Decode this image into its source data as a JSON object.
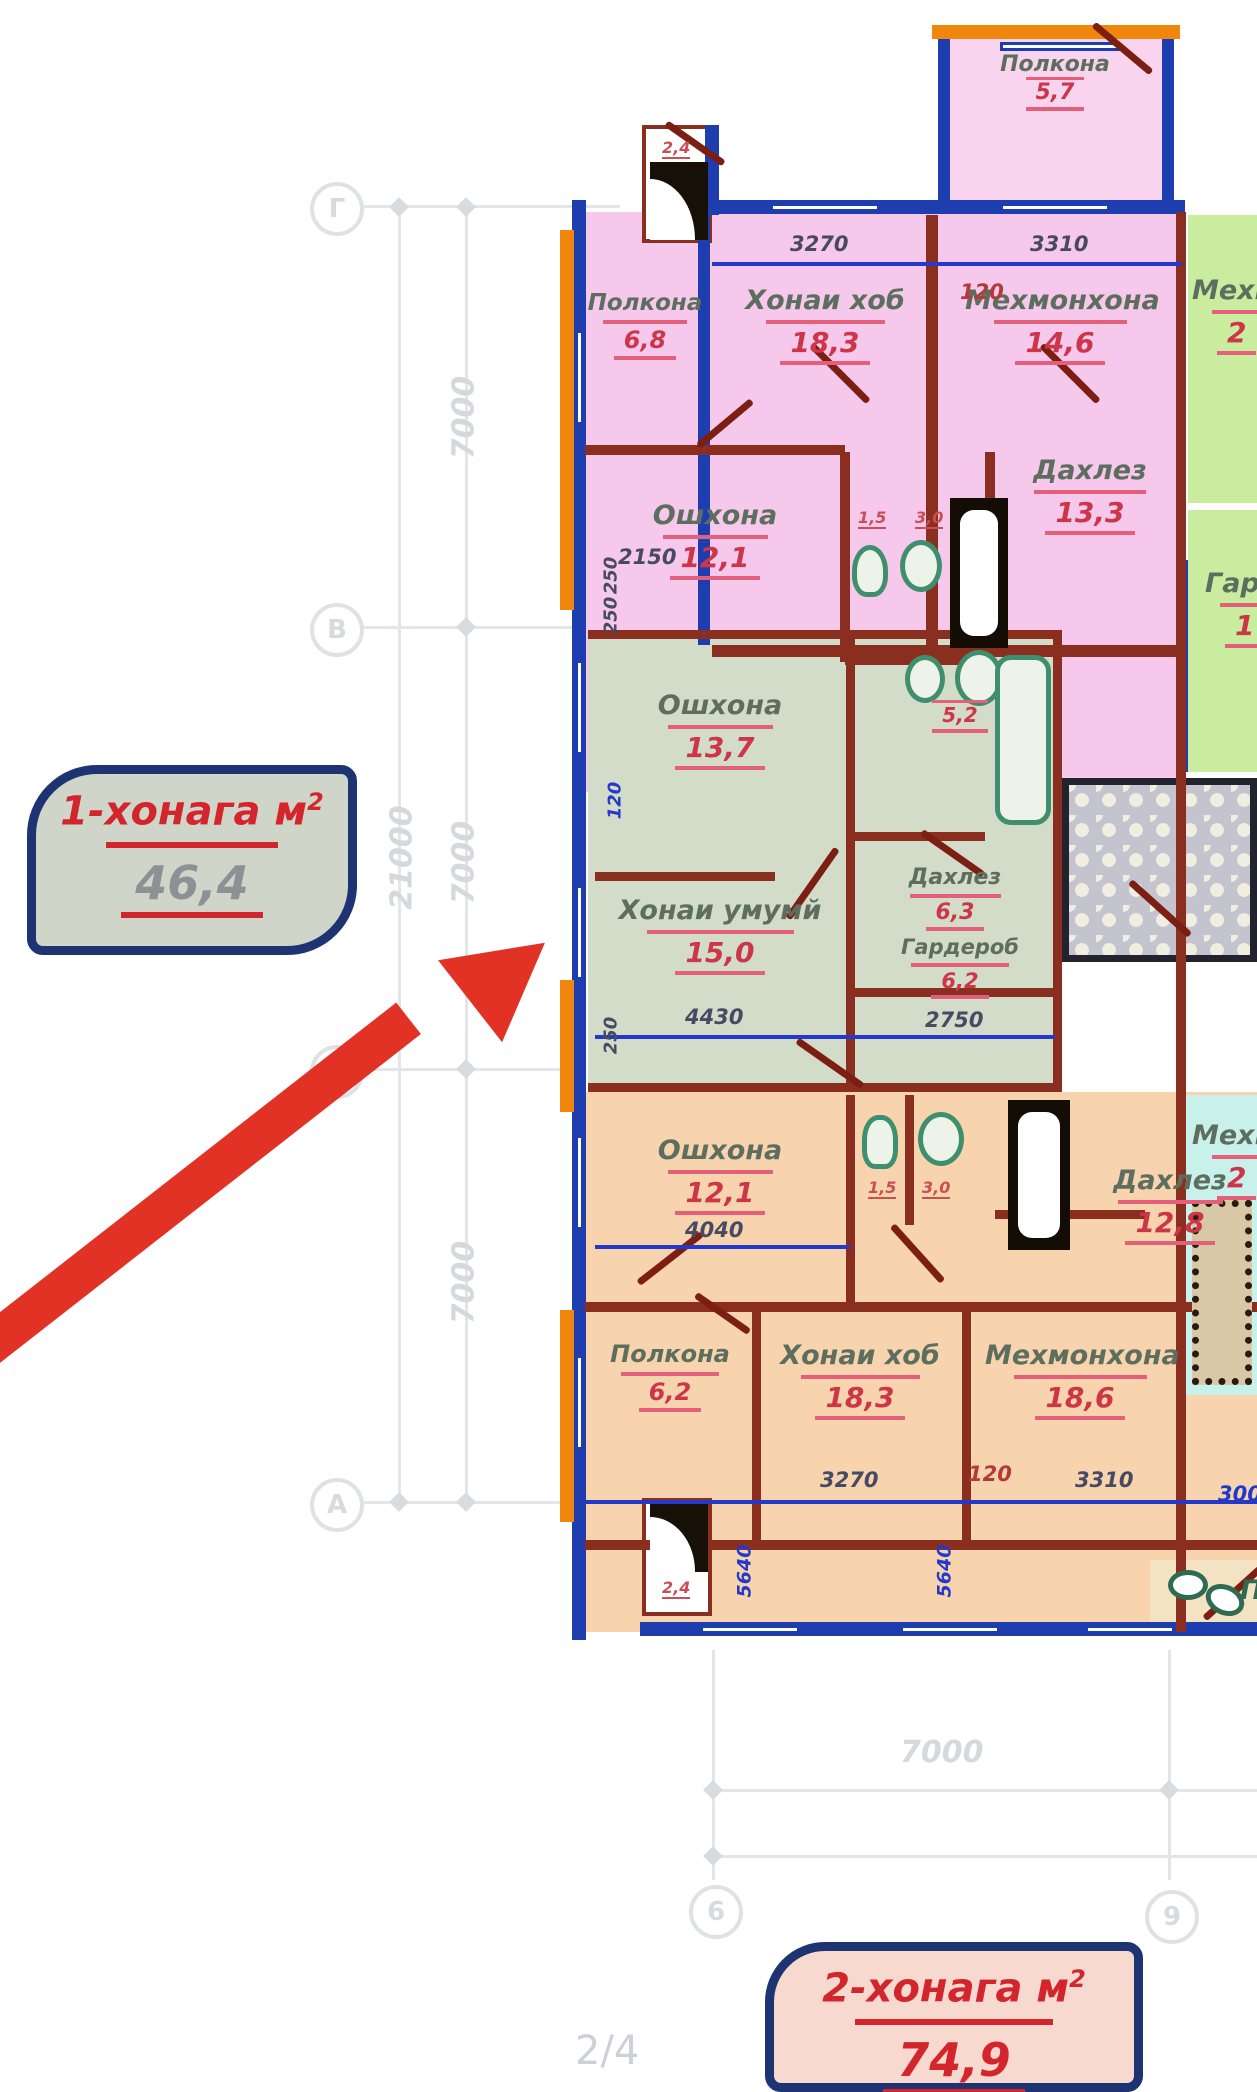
{
  "page": {
    "indicator": "2/4"
  },
  "callouts": {
    "one": {
      "title": "1-хонага м",
      "sup": "2",
      "value": "46,4"
    },
    "two": {
      "title": "2-хонага м",
      "sup": "2",
      "value": "74,9"
    }
  },
  "grid": {
    "rowLabels": [
      "Г",
      "В",
      "Б",
      "А"
    ],
    "colLabels": [
      "6",
      "9"
    ],
    "vTotal": "21000",
    "vSeg1": "7000",
    "vSeg2": "7000",
    "vSeg3": "7000",
    "hBottom": "7000"
  },
  "rooms": {
    "balconyTop": {
      "name": "Полкона",
      "area": "5,7"
    },
    "balcony24a": {
      "area": "2,4"
    },
    "balcony24b": {
      "area": "2,4"
    },
    "polkona68": {
      "name": "Полкона",
      "area": "6,8"
    },
    "khonaiKhob1": {
      "name": "Хонаи хоб",
      "area": "18,3"
    },
    "mehmonkhona1": {
      "name": "Мехмонхона",
      "area": "14,6"
    },
    "oshxona1": {
      "name": "Ошхона",
      "area": "12,1"
    },
    "dahlez1": {
      "name": "Дахлез",
      "area": "13,3"
    },
    "bath15a": {
      "area": "1,5"
    },
    "bath30a": {
      "area": "3,0"
    },
    "greenMehmon": {
      "name": "Мехм",
      "area": "2"
    },
    "greenGarderob": {
      "name": "Гар",
      "area": "1"
    },
    "oshxona2": {
      "name": "Ошхона",
      "area": "13,7"
    },
    "su52": {
      "area": "5,2"
    },
    "dahlez2": {
      "name": "Дахлез",
      "area": "6,3"
    },
    "khonaiUmumi": {
      "name": "Хонаи умумй",
      "area": "15,0"
    },
    "garderob2": {
      "name": "Гардероб",
      "area": "6,2"
    },
    "oshxona3": {
      "name": "Ошхона",
      "area": "12,1"
    },
    "bath15b": {
      "area": "1,5"
    },
    "bath30b": {
      "area": "3,0"
    },
    "dahlez3": {
      "name": "Дахлез",
      "area": "12,8"
    },
    "polkona62": {
      "name": "Полкона",
      "area": "6,2"
    },
    "khonaiKhob2": {
      "name": "Хонаи хоб",
      "area": "18,3"
    },
    "mehmonkhona2": {
      "name": "Мехмонхона",
      "area": "18,6"
    },
    "cyanMehmon": {
      "name": "Мехм",
      "area": "2"
    },
    "bottomRight": {
      "name": "П"
    }
  },
  "dims": {
    "d2150": "2150",
    "d3270t": "3270",
    "d120t": "120",
    "d3310t": "3310",
    "d250a": "250",
    "d250b": "250",
    "d120m": "120",
    "d4430": "4430",
    "d250c": "250",
    "d2750": "2750",
    "d4040": "4040",
    "d3270b": "3270",
    "d120b": "120",
    "d3310b": "3310",
    "d300": "300",
    "d5640a": "5640",
    "d5640b": "5640"
  }
}
